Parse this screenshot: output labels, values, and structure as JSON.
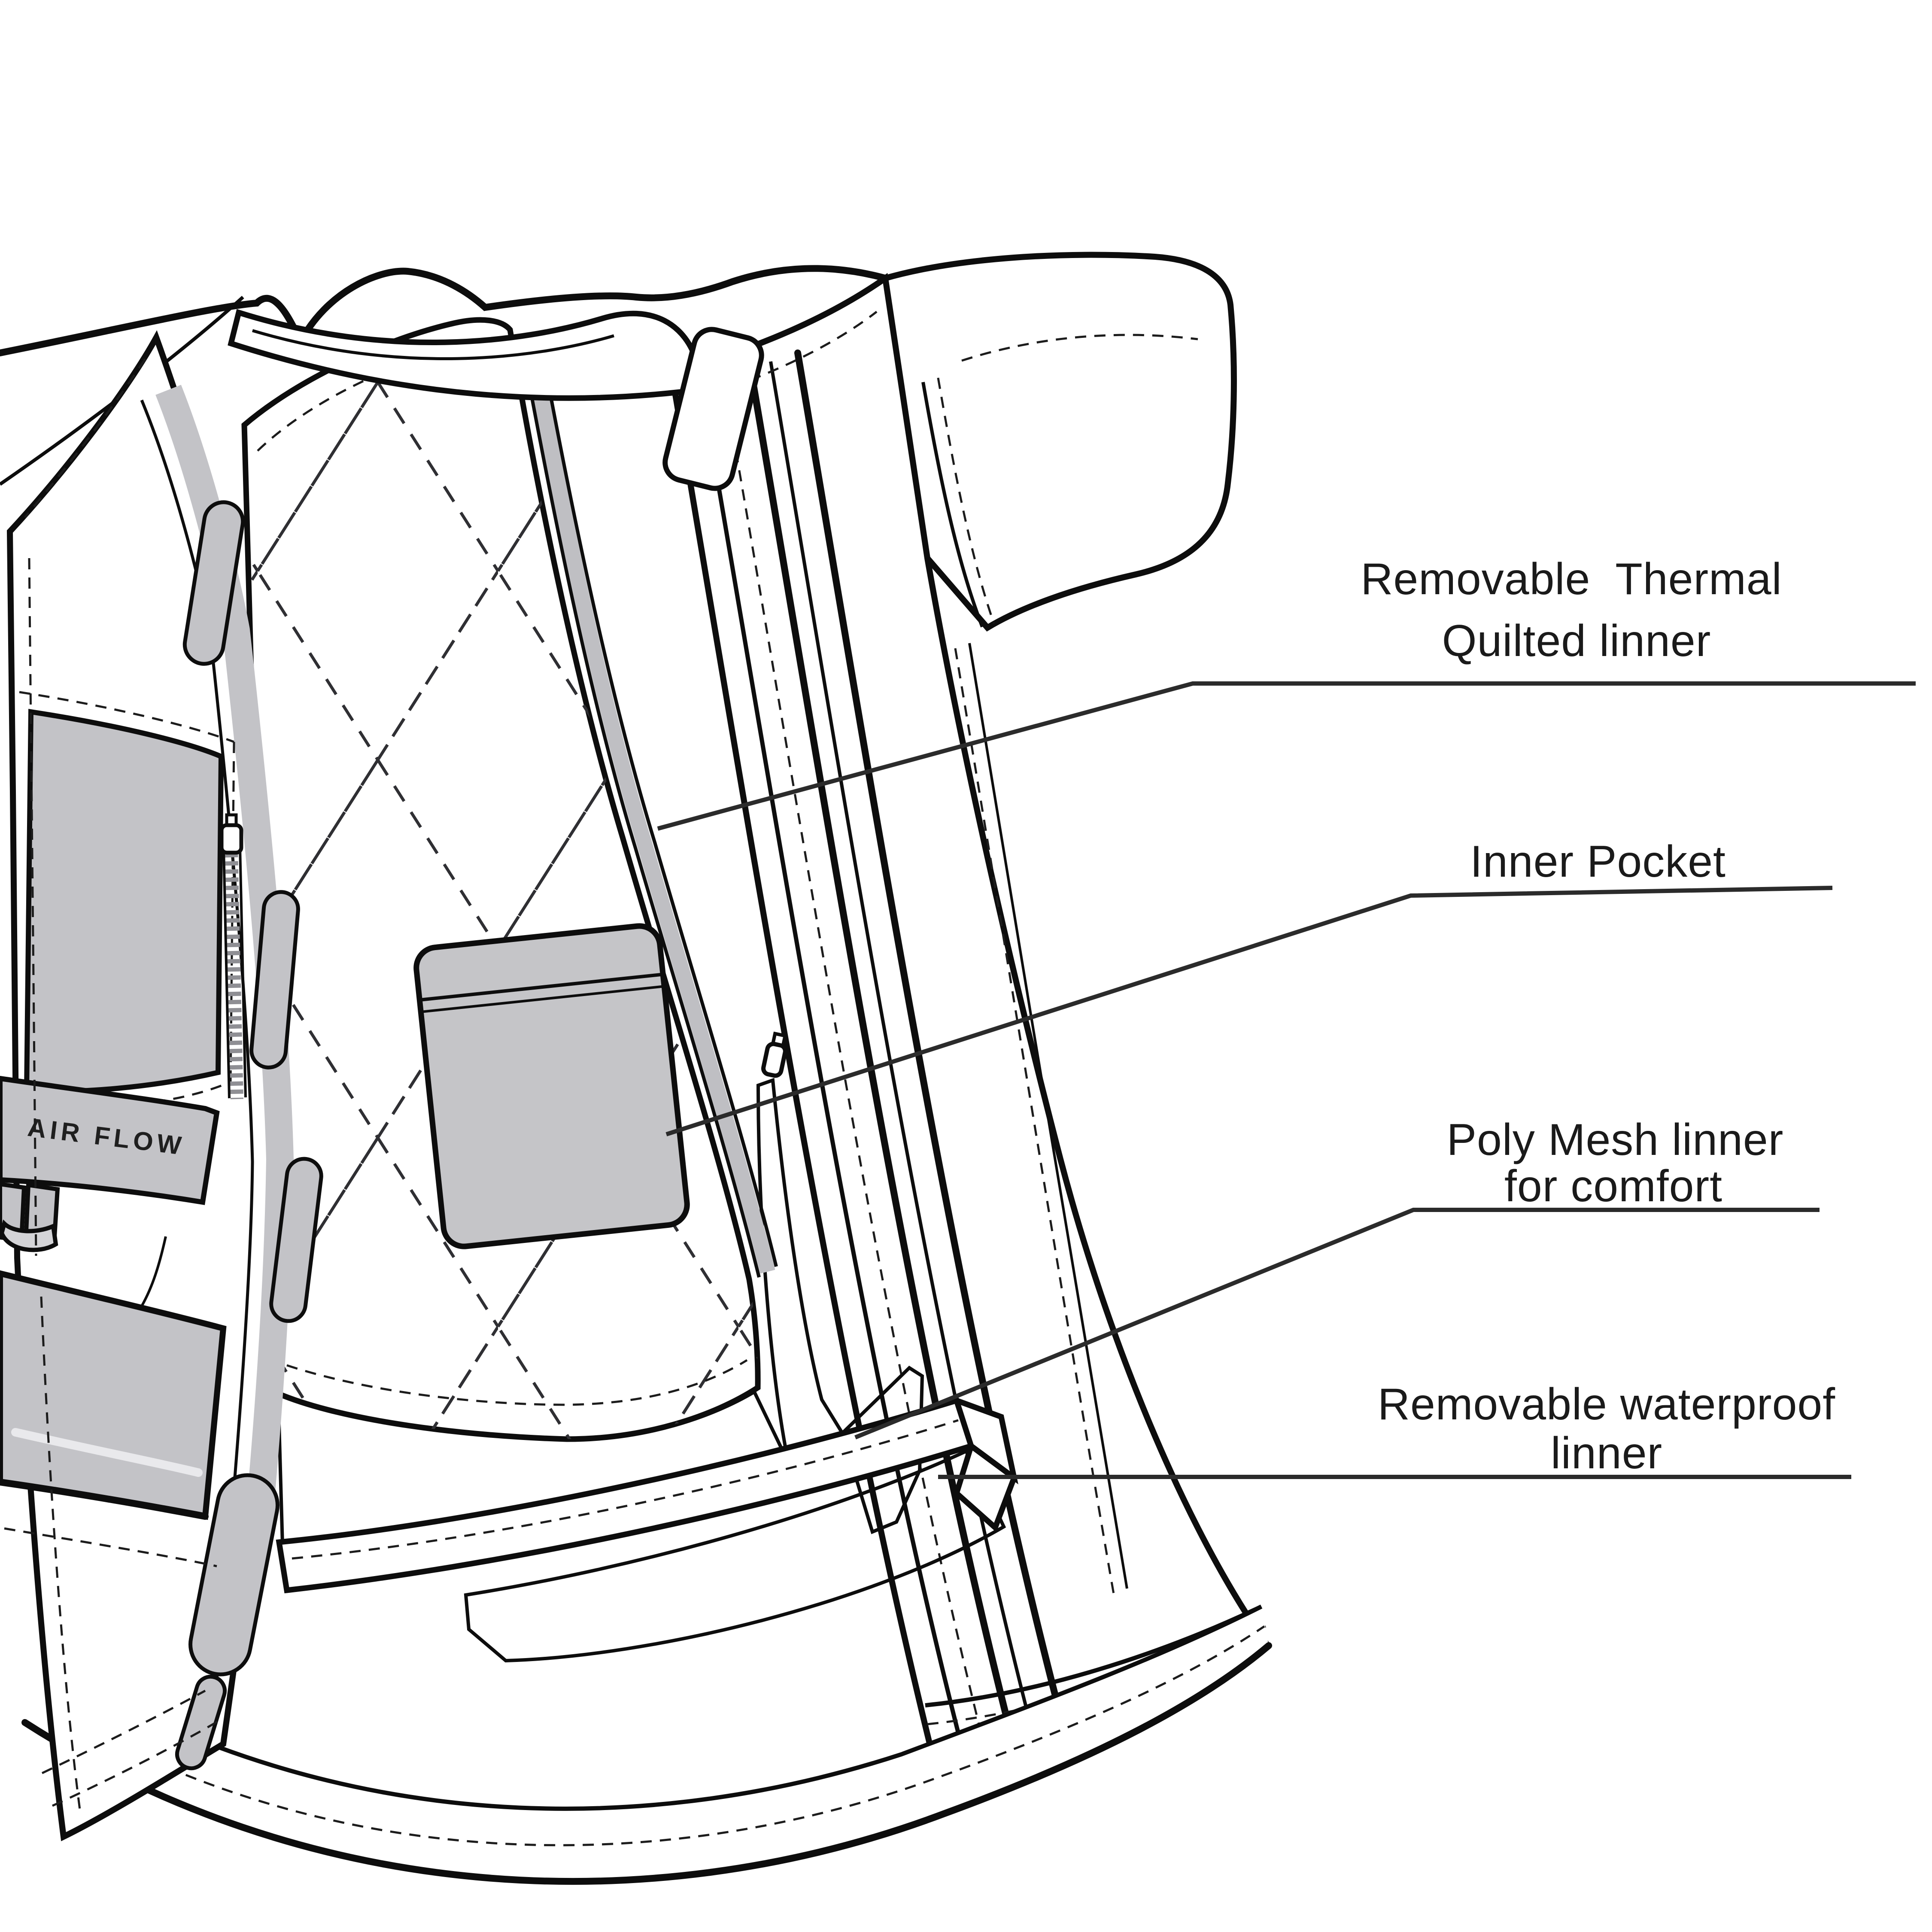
{
  "figure": {
    "kind": "garment-technical-flat-sketch",
    "subject": "motorcycle jacket opened to show inner liners",
    "air_flow_band_label": "AIR FLOW"
  },
  "callouts": [
    {
      "id": "thermal-quilted-liner",
      "line1": "Removable  Thermal",
      "line2": "Quilted linner"
    },
    {
      "id": "inner-pocket",
      "line1": "Inner Pocket"
    },
    {
      "id": "poly-mesh-liner",
      "line1": "Poly Mesh linner",
      "line2": "for comfort"
    },
    {
      "id": "waterproof-liner",
      "line1": "Removable waterproof",
      "line2": "linner"
    }
  ],
  "colors": {
    "background": "#ffffff",
    "line_art": "#0d0d0d",
    "leader_line": "#2b2b2b",
    "label_text": "#1a1a1a",
    "quilt_fill": "#c5c5c8",
    "panel_patch_fill": "#c3c3c7",
    "dark_mesh_fill": "#929297",
    "dark_mesh_grid": "#696970",
    "light_mesh_fill": "#c3c3c7",
    "light_mesh_grid": "#9c9ca2"
  }
}
